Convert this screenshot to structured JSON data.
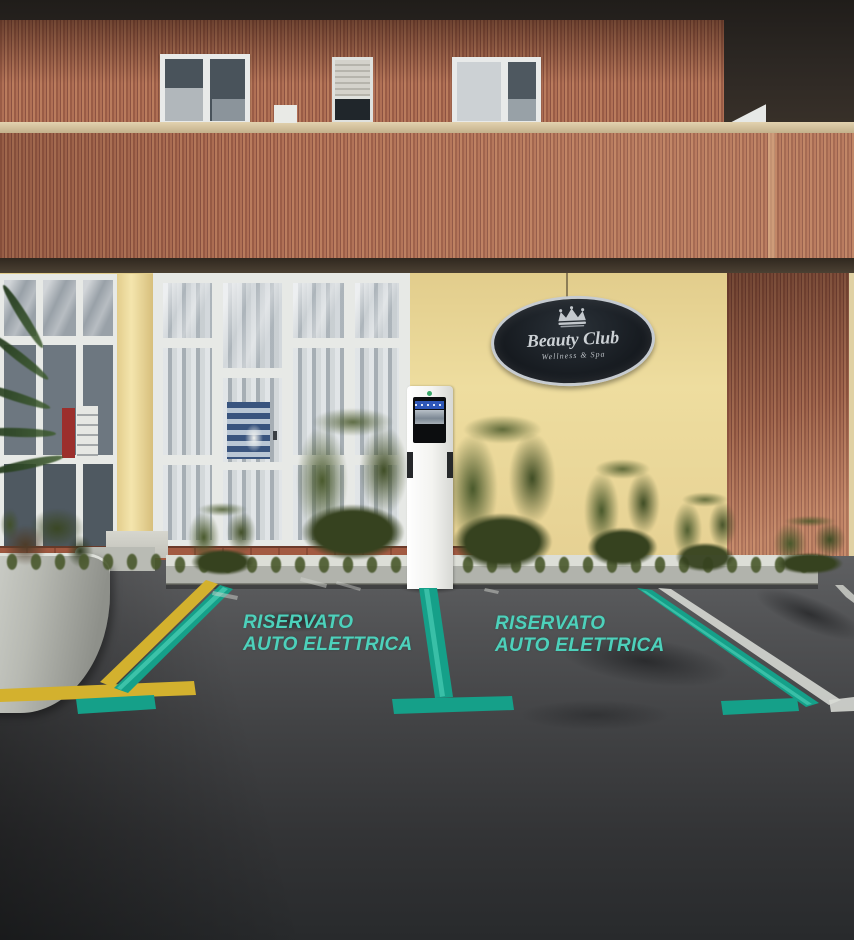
{
  "signage": {
    "beauty_club": {
      "title": "Beauty Club",
      "subtitle": "Wellness & Spa",
      "icon": "crown",
      "bg_color": "#161b20",
      "text_color": "#ccd1d5"
    }
  },
  "ground_markings": {
    "left_bay": {
      "line1": "RISERVATO",
      "line2": "AUTO ELETTRICA"
    },
    "right_bay": {
      "line1": "RISERVATO",
      "line2": "AUTO ELETTRICA"
    },
    "text_color": "#4dd1bb",
    "bay_line_color": "#15a089",
    "curb_line_color": "#d3b12e",
    "white_line_color": "#dadcd6"
  },
  "building": {
    "facade_wood_color": "#a86a52",
    "wall_color": "#e9d694"
  }
}
